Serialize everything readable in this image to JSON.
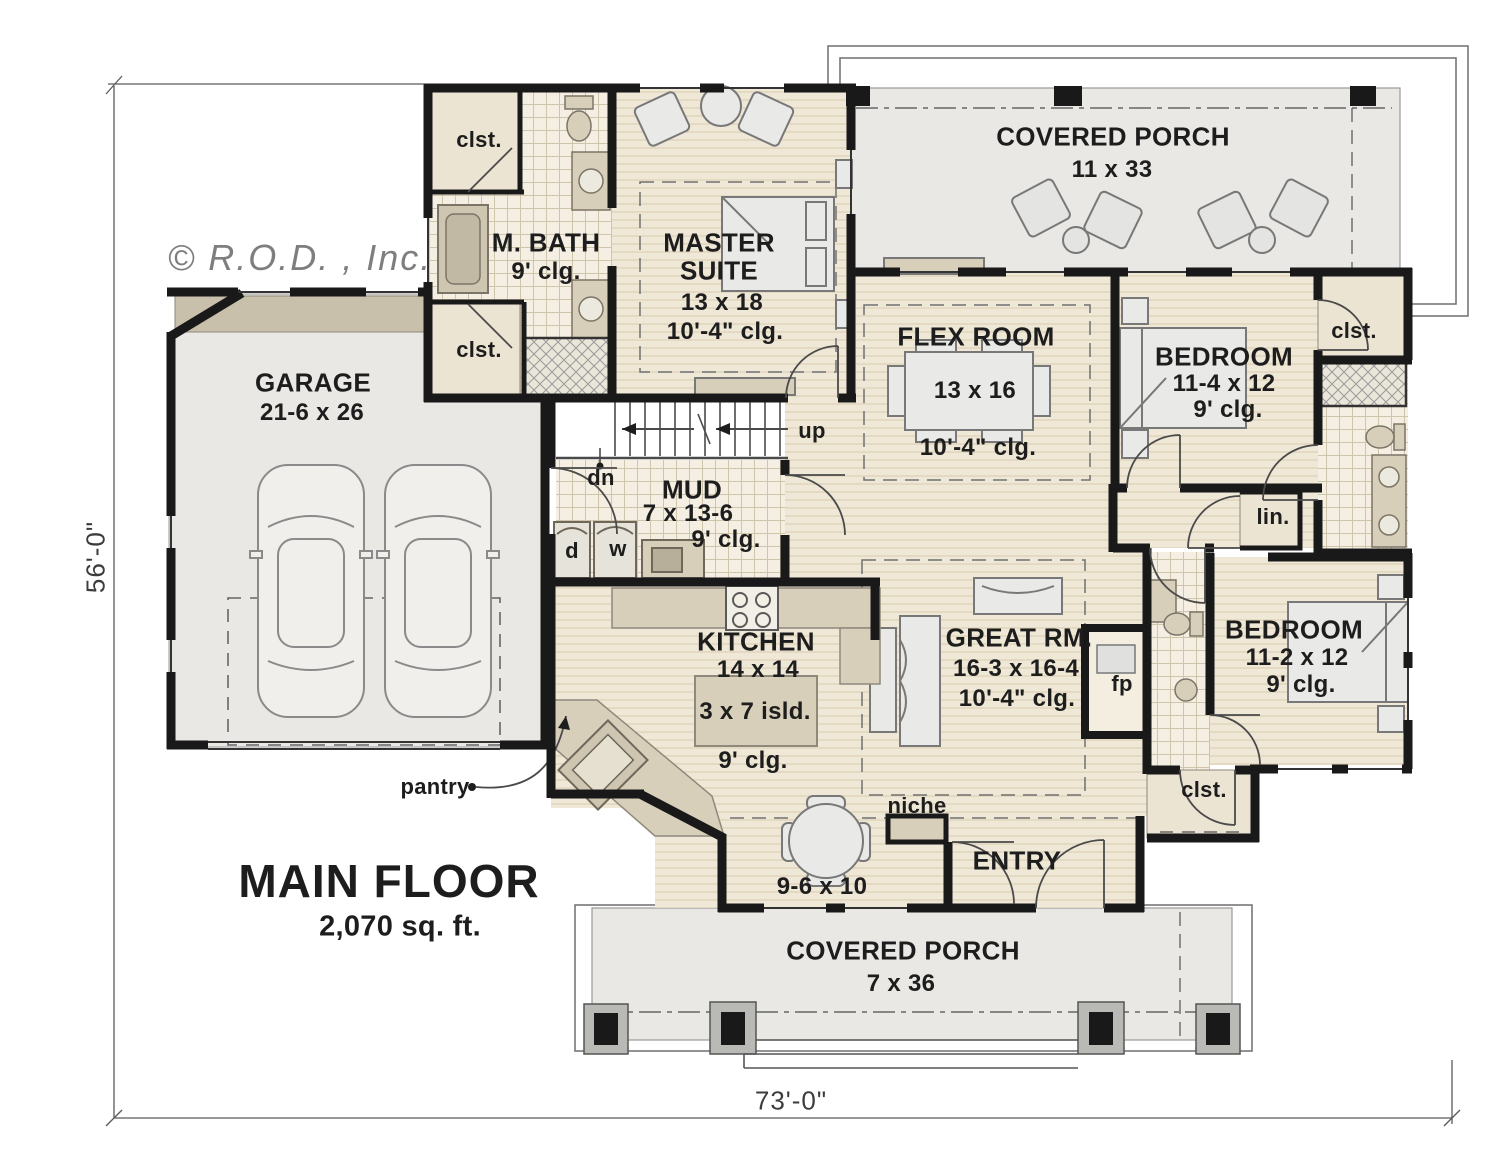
{
  "meta": {
    "copyright": "© R.O.D. , Inc."
  },
  "title_block": {
    "title": "MAIN FLOOR",
    "area": "2,070 sq. ft."
  },
  "dimensions": {
    "overall_width": "73'-0\"",
    "overall_depth": "56'-0\""
  },
  "rooms": {
    "covered_porch_rear": {
      "name": "COVERED PORCH",
      "size": "11 x 33"
    },
    "master_suite": {
      "name_line1": "MASTER",
      "name_line2": "SUITE",
      "size": "13 x 18",
      "ceiling": "10'-4\" clg."
    },
    "master_bath": {
      "name": "M. BATH",
      "ceiling": "9' clg."
    },
    "garage": {
      "name": "GARAGE",
      "size": "21-6 x 26"
    },
    "flex_room": {
      "name": "FLEX ROOM",
      "size": "13 x 16",
      "ceiling": "10'-4\" clg."
    },
    "bedroom_upper": {
      "name": "BEDROOM",
      "size": "11-4 x 12",
      "ceiling": "9' clg."
    },
    "mud_room": {
      "name": "MUD",
      "size": "7 x 13-6",
      "ceiling": "9' clg."
    },
    "kitchen": {
      "name": "KITCHEN",
      "size": "14 x 14",
      "island": "3 x 7 isld.",
      "ceiling": "9' clg."
    },
    "great_room": {
      "name": "GREAT RM.",
      "size": "16-3 x 16-4",
      "ceiling": "10'-4\" clg."
    },
    "bedroom_lower": {
      "name": "BEDROOM",
      "size": "11-2 x 12",
      "ceiling": "9' clg."
    },
    "dinette": {
      "size": "9-6 x 10"
    },
    "entry": {
      "name": "ENTRY"
    },
    "covered_porch_front": {
      "name": "COVERED PORCH",
      "size": "7 x 36"
    }
  },
  "annotations": {
    "closet": "clst.",
    "linen": "lin.",
    "niche": "niche",
    "pantry": "pantry",
    "stairs_up": "up",
    "stairs_down": "dn",
    "dryer": "d",
    "washer": "w",
    "fireplace": "fp"
  },
  "colors": {
    "wall": "#191919",
    "floor_wood": "#efe8d7",
    "floor_tile": "#f4efe2",
    "porch": "#e9e8e4",
    "counter": "#d8cfba",
    "text": "#1d1d1d",
    "copyright_gray": "#7e7e7e"
  }
}
